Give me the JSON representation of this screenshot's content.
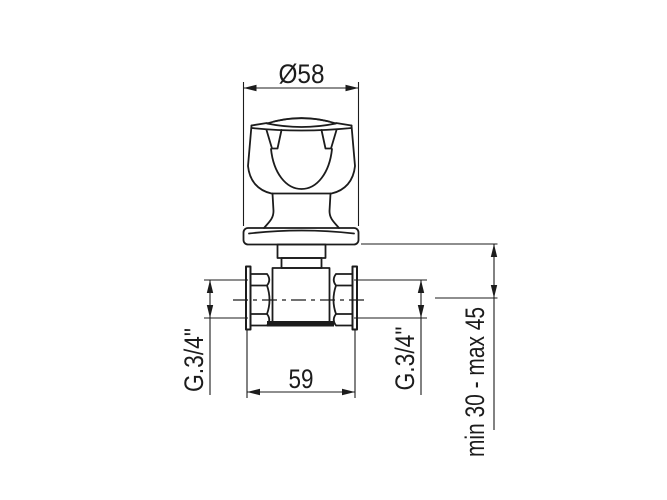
{
  "page": {
    "background": "#ffffff",
    "line_color": "#1c1c1c",
    "description": "Technical dimension drawing of a concealed wall valve with knob handle"
  },
  "drawing": {
    "labels": {
      "diameter_top": "Ø58",
      "body_width": "59",
      "thread_left": "G.3/4\"",
      "thread_right": "G.3/4\"",
      "installation_depth": "min 30 - max 45"
    }
  }
}
